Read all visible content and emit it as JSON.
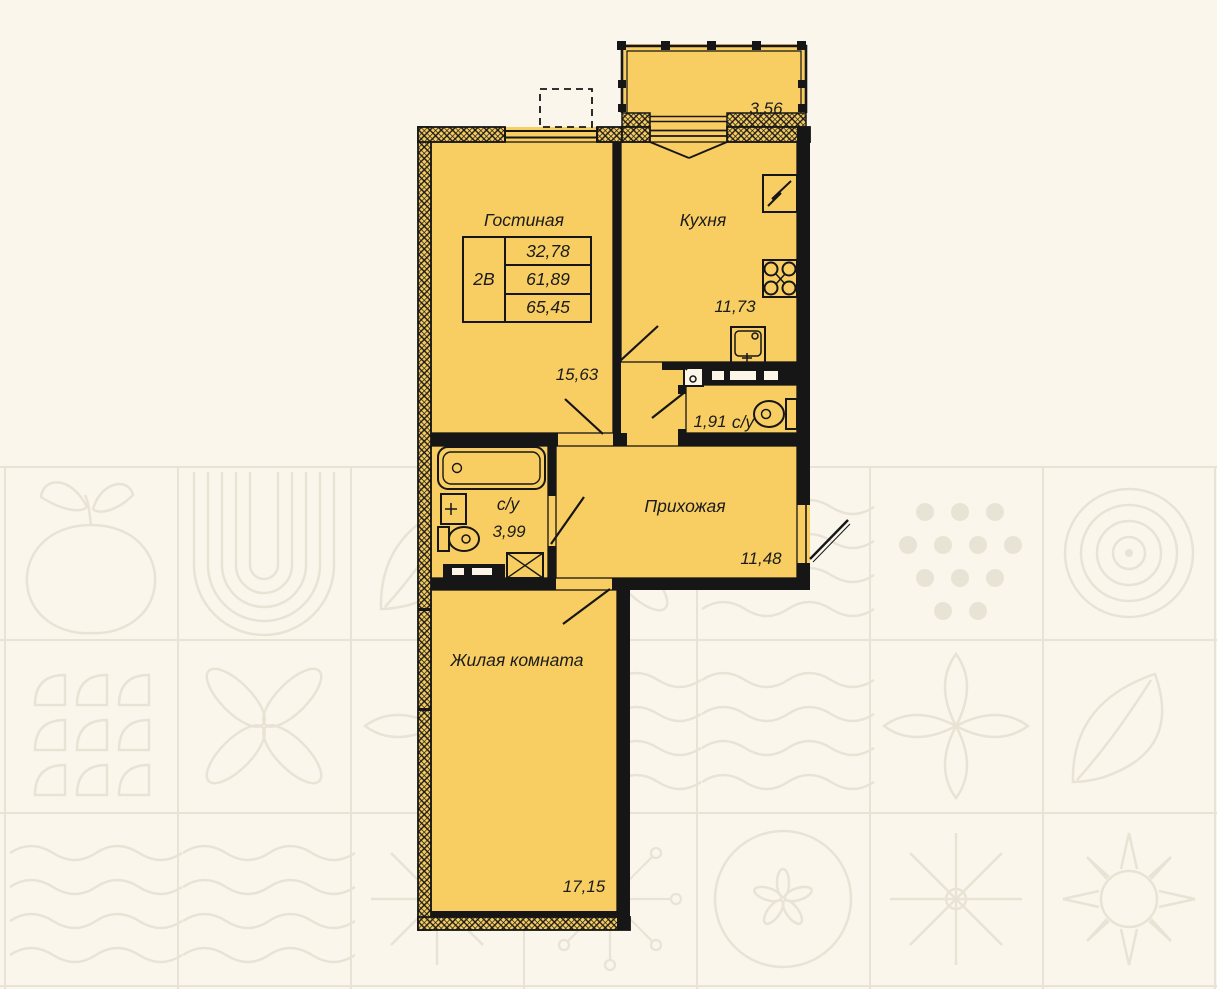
{
  "info_table": {
    "unit": "2В",
    "living_area": "32,78",
    "area": "61,89",
    "total_area": "65,45"
  },
  "rooms": {
    "living": {
      "label": "Гостиная",
      "area": "15,63"
    },
    "kitchen": {
      "label": "Кухня",
      "area": "11,73"
    },
    "bathroom_small": {
      "label": "с/у",
      "area": "1,91"
    },
    "hallway": {
      "label": "Прихожая",
      "area": "11,48"
    },
    "bathroom_main": {
      "label": "с/у",
      "area": "3,99"
    },
    "bedroom": {
      "label": "Жилая комната",
      "area": "17,15"
    },
    "balcony": {
      "area": "3,56"
    }
  },
  "colors": {
    "room_fill": "#f8ce63",
    "wall": "#161616",
    "background": "#faf6ec",
    "pattern_line": "#e9e3d5",
    "text": "#1b1b1b"
  }
}
